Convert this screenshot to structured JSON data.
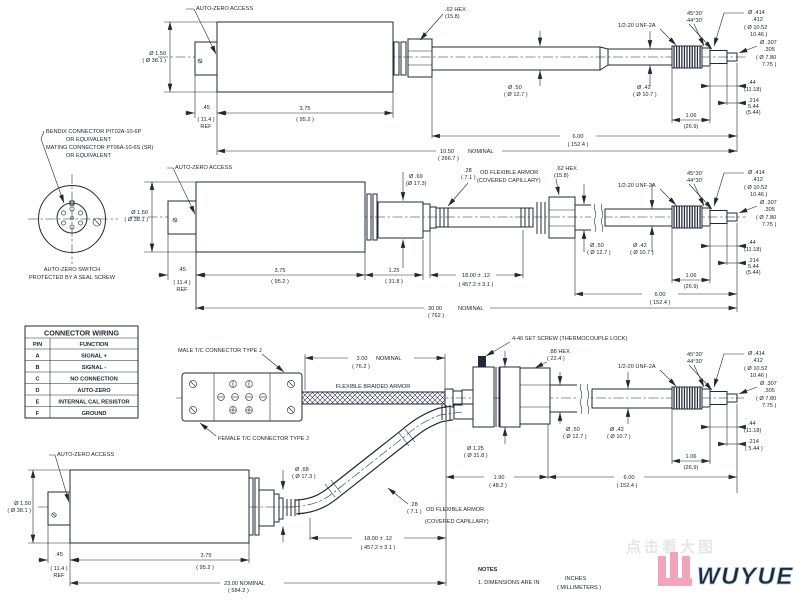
{
  "page": {
    "background": "#ffffff",
    "line_color": "#232836"
  },
  "callouts": {
    "autozero_access": "AUTO-ZERO ACCESS",
    "bendix_l1": "BENDIX CONNECTOR PIT02A-10-6P",
    "bendix_l2": "OR EQUIVALENT",
    "bendix_l3": "MATING CONNECTOR PT06A-10-6S (SR)",
    "bendix_l4": "OR EQUIVALENT",
    "autozero_switch_l1": "AUTO-ZERO SWITCH",
    "autozero_switch_l2": "PROTECTED BY A SEAL SCREW",
    "hex62_l1": ".62 HEX",
    "hex62_l2": "(15.8)",
    "thread_unf": "1/2-20 UNF-2A",
    "angle_l1": "45°30'",
    "angle_l2": "44°30'",
    "set_screw": "4-40 SET SCREW (THERMOCOUPLE LOCK)",
    "hex88_l1": ".88 HEX",
    "hex88_l2": "( 22.4 )",
    "male_tc": "MALE T/C CONNECTOR TYPE J",
    "female_tc": "FEMALE T/C CONNECTOR TYPE J",
    "braided_armor": "FLEXIBLE BRAIDED ARMOR",
    "armor_l1": ".28",
    "armor_l2": "( 7.1 )",
    "armor_l3": "OD FLEXIBLE ARMOR",
    "armor_l4": "(COVERED CAPILLARY)"
  },
  "dims": {
    "dia150_l1": "Ø 1.50",
    "dia150_l2": "( Ø 38.1 )",
    "d45_l1": ".45",
    "d45_l2": "( 11.4 )",
    "d45_l3": "REF",
    "d375_l1": "3.75",
    "d375_l2": "( 95.2 )",
    "d125_l1": "1.25",
    "d125_l2": "( 31.8 )",
    "dia69_l1": "Ø .69",
    "dia69_l2": "(Ø 17.3)",
    "dia68_l1": "Ø .68",
    "dia68_l2": "( Ø 17.3 )",
    "dia50_l1": "Ø .50",
    "dia50_l2": "( Ø 12.7 )",
    "dia42_l1": "Ø .42",
    "dia42_l2": "( Ø 10.7 )",
    "dia125_l1": "Ø 1.25",
    "dia125_l2": "( Ø 31.8 )",
    "dia414_l1": "Ø .414",
    "dia414_l2": ".412",
    "dia414_l3": "( Ø 10.52",
    "dia414_l4": "10.46 )",
    "dia307_l1": "Ø .307",
    "dia307_l2": ".305",
    "dia307_l3": "( Ø 7.80",
    "dia307_l4": "7.75 )",
    "d44_l1": ".44",
    "d44_l2": "(11.18)",
    "d214_l1": ".214",
    "d214_l2": "5.44",
    "d214_l3": "(5.44)",
    "d214b_l1": ".214",
    "d214b_l2": "( 5.44 )",
    "d106_l1": "1.06",
    "d106_l2": "(26.9)",
    "d600_l1": "6.00",
    "d600_l2": "( 152.4 )",
    "d1050_l1": "10.50",
    "d1050_l2": "( 266.7 )",
    "d3000_l1": "30.00",
    "d3000_l2": "( 762 )",
    "d2300_l1": "23.00 NOMINAL",
    "d2300_l2": "( 584.2 )",
    "d1800_l1": "18.00 ± .12",
    "d1800_l2": "( 457.2 ± 3.1 )",
    "d300_l1": "3.00",
    "d300_l2": "( 76.2 )",
    "d190_l1": "1.90",
    "d190_l2": "( 48.2 )",
    "nominal": "NOMINAL"
  },
  "table": {
    "title": "CONNECTOR WIRING",
    "col_pin": "PIN",
    "col_function": "FUNCTION",
    "rows": [
      {
        "pin": "A",
        "fn": "SIGNAL +"
      },
      {
        "pin": "B",
        "fn": "SIGNAL -"
      },
      {
        "pin": "C",
        "fn": "NO CONNECTION"
      },
      {
        "pin": "D",
        "fn": "AUTO-ZERO"
      },
      {
        "pin": "E",
        "fn": "INTERNAL CAL RESISTOR"
      },
      {
        "pin": "F",
        "fn": "GROUND"
      }
    ]
  },
  "notes": {
    "title": "NOTES",
    "item1": "1. DIMENSIONS ARE IN",
    "units_inches": "INCHES",
    "units_mm": "( MILLIMETERS )"
  },
  "footer": {
    "watermark": "点击看大图",
    "brand": "WUYUE",
    "brand_color": "#c6dff4",
    "mark_color": "#f2a5ba"
  }
}
